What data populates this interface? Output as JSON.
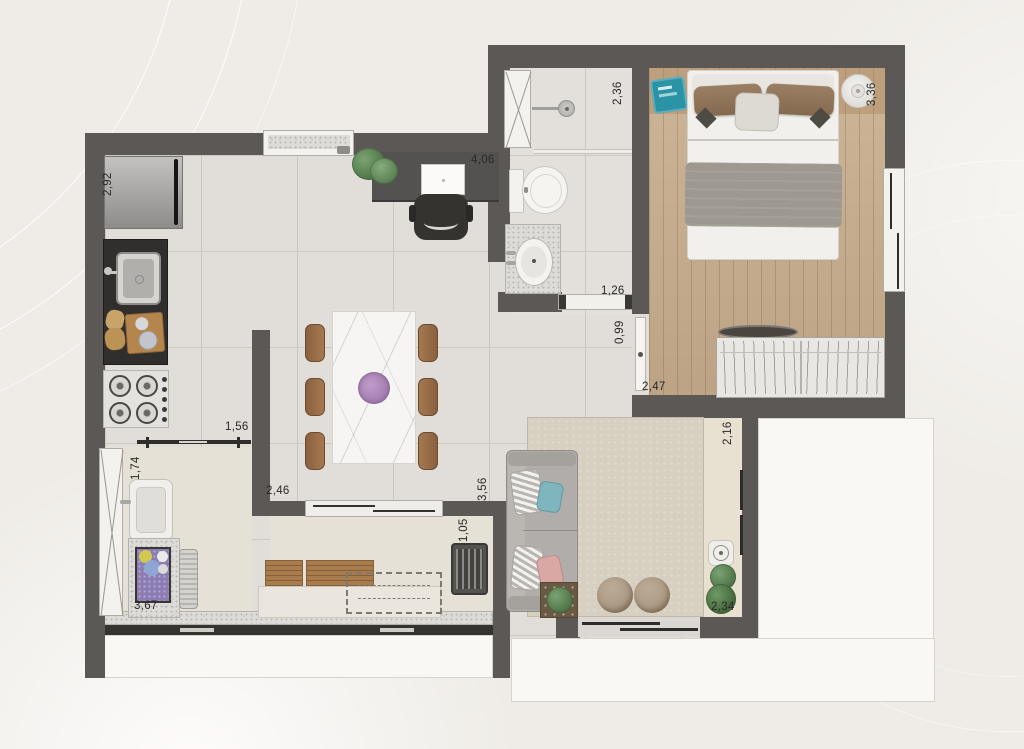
{
  "plan_type": "apartment-floor-plan",
  "dimensions_m": {
    "kitchen_side_wall": "2,92",
    "top_wall_span": "4,06",
    "bathroom_depth": "2,36",
    "bedroom_width": "3,36",
    "bath_counter_span": "1,26",
    "hall_passage": "0,99",
    "bedroom_bottom_span": "2,47",
    "balcony_side": "2,16",
    "kitchen_passage": "1,56",
    "laundry_width": "1,74",
    "dining_wall_span": "2,46",
    "living_divider": "3,56",
    "grill_counter": "1,05",
    "service_balcony_span": "3,67",
    "living_balcony_door": "2,34"
  },
  "colors": {
    "wall": "#5b5856",
    "floor_tile": "#e1ddd8",
    "wood_floor": "#c7ac8c",
    "granite": "#dddcd8",
    "accent_teal": "#2a93a6",
    "accent_purple": "#8b7cb4",
    "sofa_gray": "#b0adaa",
    "plant_green": "#5c8a5f",
    "background": "#efece7"
  },
  "furniture_legend": [
    "fridge",
    "kitchen-sink",
    "stove",
    "cutting-board",
    "dining-table",
    "dining-chairs",
    "desk",
    "laptop",
    "office-chair",
    "monstera-plant",
    "toilet",
    "shower-head",
    "washbasin-counter",
    "bathroom-window",
    "double-bed",
    "bedside-lamp",
    "bedside-tray",
    "wardrobe",
    "floor-tray",
    "bedroom-window",
    "sofa",
    "throw-pillows",
    "rug",
    "poufs",
    "side-table",
    "speaker",
    "balcony-plants",
    "laundry-tank",
    "washboard",
    "laundry-basket",
    "laundry-window",
    "bench",
    "folding-table",
    "grill-counter",
    "sliding-doors"
  ]
}
